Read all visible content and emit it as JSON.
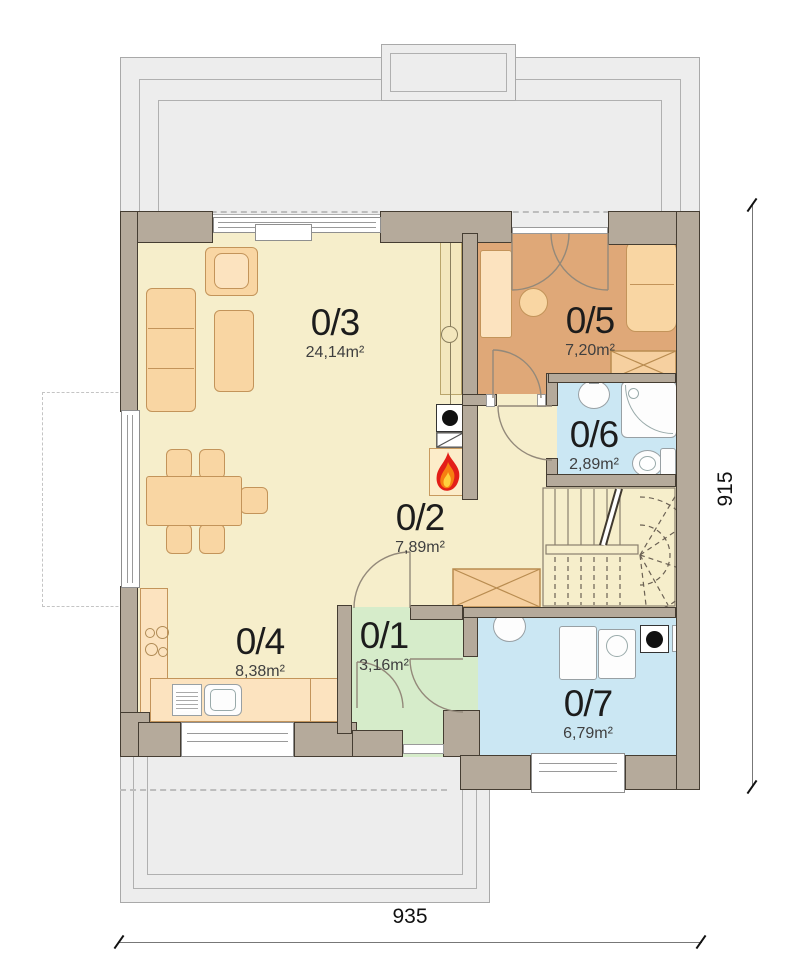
{
  "rooms": {
    "r01": {
      "label": "0/1",
      "area": "3,16m²"
    },
    "r02": {
      "label": "0/2",
      "area": "7,89m²"
    },
    "r03": {
      "label": "0/3",
      "area": "24,14m²"
    },
    "r04": {
      "label": "0/4",
      "area": "8,38m²"
    },
    "r05": {
      "label": "0/5",
      "area": "7,20m²"
    },
    "r06": {
      "label": "0/6",
      "area": "2,89m²"
    },
    "r07": {
      "label": "0/7",
      "area": "6,79m²"
    }
  },
  "dimensions": {
    "width_label": "935",
    "height_label": "915"
  },
  "palette": {
    "wall": "#b5aa9b",
    "floor_main": "#f6eecb",
    "floor_r05": "#dfa878",
    "floor_r01": "#d6ecca",
    "floor_bath": "#cbe7f3",
    "furniture": "#f9d6a3",
    "terrace": "#ededed",
    "flame_red": "#e31e18",
    "flame_orange": "#f77f11",
    "flame_yellow": "#ffd23e"
  }
}
